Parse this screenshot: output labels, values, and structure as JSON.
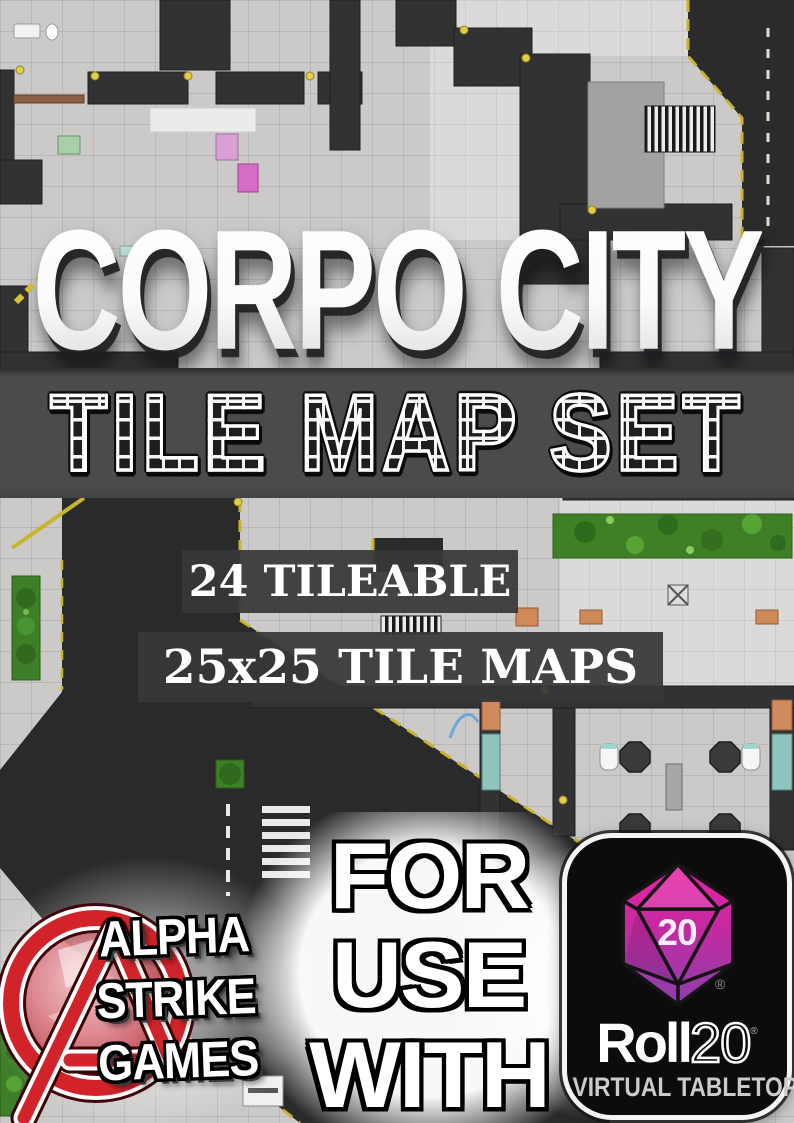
{
  "title": {
    "text": "CORPO CITY"
  },
  "banner": {
    "text": "TILE MAP SET"
  },
  "features": {
    "line1": "24 TILEABLE",
    "line2": "25x25 TILE MAPS"
  },
  "compatibility": {
    "word1": "FOR",
    "word2": "USE",
    "word3": "WITH"
  },
  "publisher": {
    "name_line1": "ALPHA",
    "name_line2": "STRIKE",
    "name_line3": "GAMES"
  },
  "roll20_badge": {
    "die_value": "20",
    "registered_mark": "®",
    "brand_word": "Roll",
    "brand_number": "20",
    "tagline": "VIRTUAL TABLETOP"
  },
  "icons": {
    "d20": "d20-die-icon",
    "publisher_mark": "alpha-strike-a-ring-icon"
  },
  "colors": {
    "title_white": "#ffffff",
    "banner_bg": "#4b4a4d",
    "overlay_bg": "#373739",
    "logo_red": "#d2232a",
    "die_pink_top": "#ee1fa6",
    "die_purple_bottom": "#8e3fae",
    "badge_bg": "#0c0c0d",
    "tagline_gray": "#c9ccc9",
    "road_dark": "#2a2a2b",
    "lawn_green": "#3f8026",
    "hazard_yellow": "#c9b42e"
  }
}
